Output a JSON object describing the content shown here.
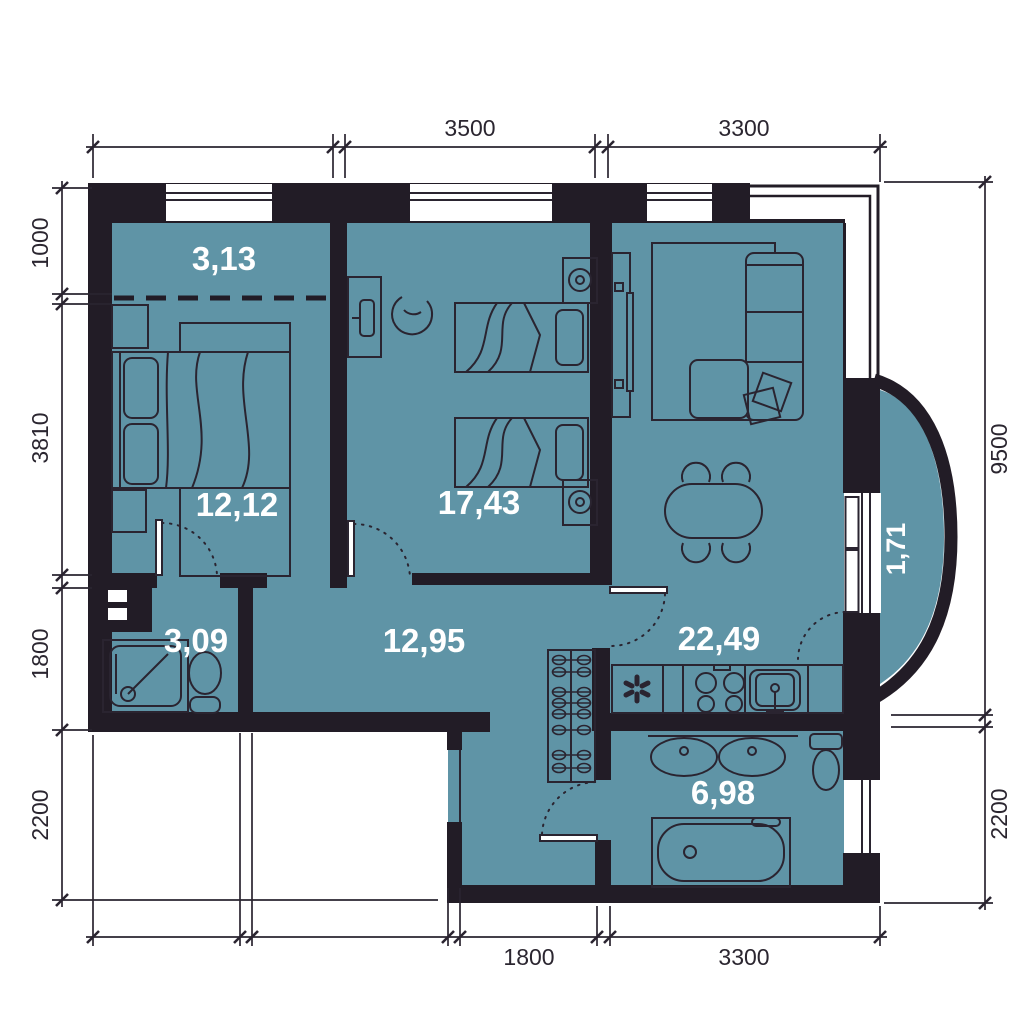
{
  "plan": {
    "colors": {
      "floor": "#5f94a6",
      "wall": "#221c26",
      "line": "#2a2430",
      "room_label_text": "#ffffff",
      "dimension_text": "#2b2630",
      "background": "#ffffff"
    },
    "rooms": [
      {
        "name": "closet-niche",
        "area": "3,13"
      },
      {
        "name": "bedroom",
        "area": "12,12"
      },
      {
        "name": "kids-room",
        "area": "17,43"
      },
      {
        "name": "hallway",
        "area": "12,95"
      },
      {
        "name": "shower-room",
        "area": "3,09"
      },
      {
        "name": "kitchen-living-room",
        "area": "22,49"
      },
      {
        "name": "balcony",
        "area": "1,71"
      },
      {
        "name": "bathroom",
        "area": "6,98"
      }
    ],
    "dimensions": {
      "top": [
        "3500",
        "3300"
      ],
      "bottom": [
        "1800",
        "3300"
      ],
      "left": [
        "1000",
        "3810",
        "1800",
        "2200"
      ],
      "right": [
        "9500",
        "2200"
      ]
    }
  }
}
